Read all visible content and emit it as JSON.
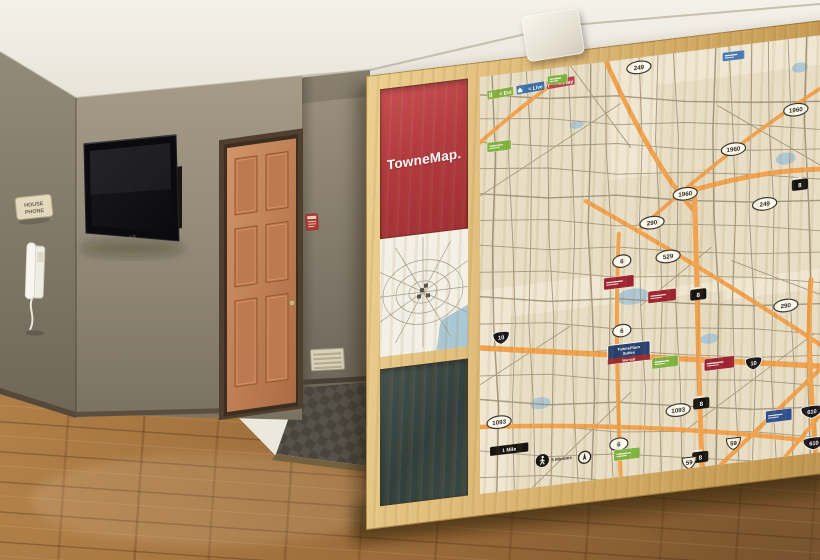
{
  "scene": {
    "tv_brand": "LG",
    "house_phone_sign": {
      "line1": "HOUSE",
      "line2": "PHONE"
    }
  },
  "map_wall": {
    "sign_title": "TowneMap.",
    "legend": [
      {
        "label": "= Eat",
        "color": "#86b03c",
        "icon": "utensils-icon"
      },
      {
        "label": "= Live",
        "color": "#3d6fa8",
        "icon": "house-icon"
      },
      {
        "label": "= Play",
        "color": "#b8454a",
        "icon": "flag-icon"
      }
    ],
    "hotel_marker": {
      "line1": "TownePlace",
      "line2": "Suites",
      "brand": "Marriott",
      "bg": "#27406e",
      "brand_bg": "#9c2a31",
      "x": 148,
      "y": 296
    },
    "scale_label": "1 Mile",
    "walk_label": "5 Minutes",
    "route_markers": [
      {
        "type": "oval",
        "label": "249",
        "x": 158,
        "y": 10
      },
      {
        "type": "oval",
        "label": "1960",
        "x": 314,
        "y": 72
      },
      {
        "type": "oval",
        "label": "1960",
        "x": 252,
        "y": 104
      },
      {
        "type": "oval",
        "label": "1960",
        "x": 204,
        "y": 143
      },
      {
        "type": "beltway",
        "label": "8",
        "x": 318,
        "y": 148
      },
      {
        "type": "oval",
        "label": "249",
        "x": 283,
        "y": 163
      },
      {
        "type": "oval",
        "label": "290",
        "x": 171,
        "y": 168
      },
      {
        "type": "oval",
        "label": "529",
        "x": 187,
        "y": 204
      },
      {
        "type": "oval",
        "label": "6",
        "x": 141,
        "y": 203
      },
      {
        "type": "beltway",
        "label": "8",
        "x": 217,
        "y": 246
      },
      {
        "type": "oval",
        "label": "290",
        "x": 304,
        "y": 268
      },
      {
        "type": "oval",
        "label": "6",
        "x": 141,
        "y": 273
      },
      {
        "type": "interstate",
        "label": "10",
        "x": 21,
        "y": 265
      },
      {
        "type": "interstate",
        "label": "10",
        "x": 272,
        "y": 322
      },
      {
        "type": "beltway",
        "label": "8",
        "x": 220,
        "y": 356
      },
      {
        "type": "interstate",
        "label": "610",
        "x": 330,
        "y": 378
      },
      {
        "type": "oval",
        "label": "1093",
        "x": 19,
        "y": 350
      },
      {
        "type": "oval",
        "label": "1093",
        "x": 197,
        "y": 360
      },
      {
        "type": "oval",
        "label": "6",
        "x": 138,
        "y": 387
      },
      {
        "type": "beltway",
        "label": "8",
        "x": 219,
        "y": 410
      },
      {
        "type": "us",
        "label": "59",
        "x": 252,
        "y": 400
      },
      {
        "type": "us",
        "label": "59",
        "x": 208,
        "y": 414
      },
      {
        "type": "interstate",
        "label": "610",
        "x": 332,
        "y": 410
      }
    ],
    "poi_markers": [
      {
        "color": "#7fb441",
        "x": 19,
        "y": 72,
        "w": 24,
        "h": 10
      },
      {
        "color": "#7fb441",
        "x": 77,
        "y": 12,
        "w": 20,
        "h": 9
      },
      {
        "color": "#4a7ab5",
        "x": 252,
        "y": 10,
        "w": 22,
        "h": 9
      },
      {
        "color": "#9e2330",
        "x": 138,
        "y": 224,
        "w": 30,
        "h": 12
      },
      {
        "color": "#9e2330",
        "x": 181,
        "y": 243,
        "w": 28,
        "h": 12
      },
      {
        "color": "#9e2330",
        "x": 238,
        "y": 318,
        "w": 30,
        "h": 12
      },
      {
        "color": "#7fb441",
        "x": 184,
        "y": 310,
        "w": 26,
        "h": 11
      },
      {
        "color": "#7fb441",
        "x": 146,
        "y": 398,
        "w": 26,
        "h": 11
      },
      {
        "color": "#2f4f8f",
        "x": 297,
        "y": 378,
        "w": 26,
        "h": 12
      }
    ],
    "colors": {
      "highway": "#f0a24e",
      "map_bg": "#efe7d2",
      "patch": "#e2d7ba",
      "water": "#adc8d4",
      "road": "#988d75",
      "brand_red": "#b23a3f",
      "wood_frame": "#d9b26b",
      "chalkboard": "#36433f",
      "door": "#c5845a"
    }
  }
}
